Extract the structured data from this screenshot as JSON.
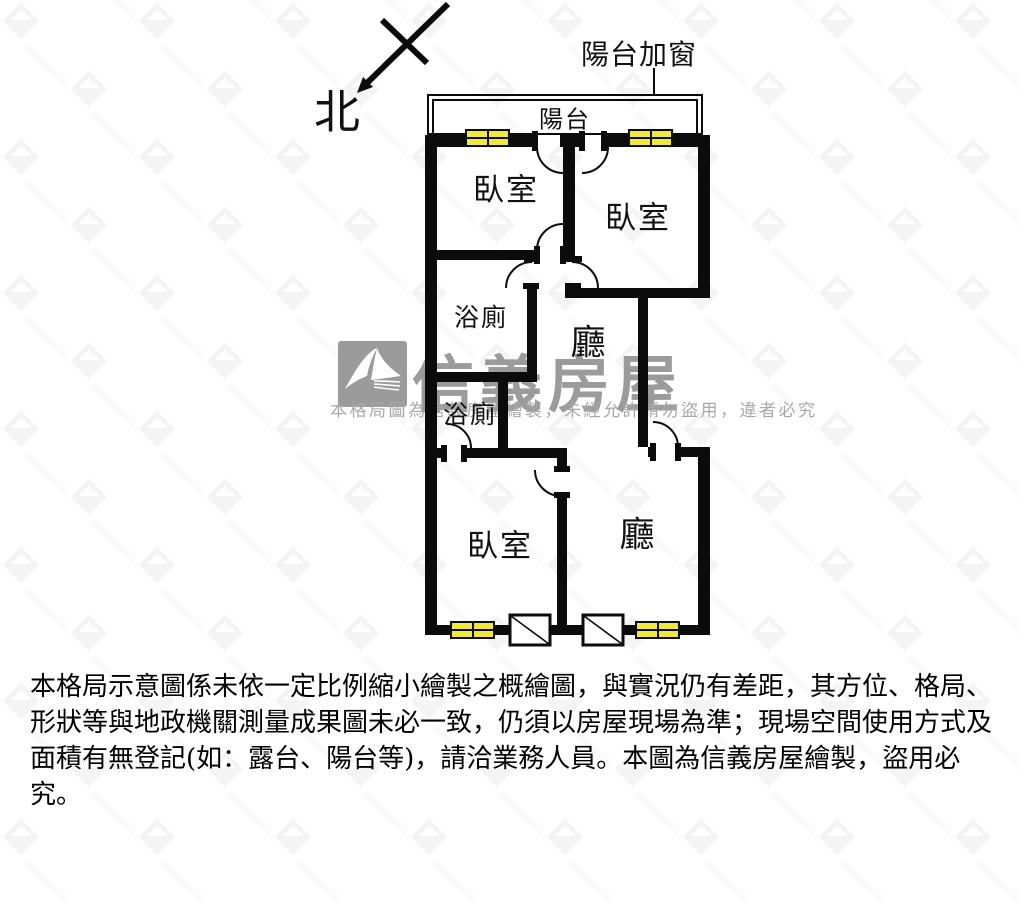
{
  "compass_label": "北",
  "balcony_window_note": "陽台加窗",
  "rooms": {
    "balcony": "陽台",
    "bedroom_top_left": "臥室",
    "bedroom_top_right": "臥室",
    "bathroom_upper": "浴廁",
    "bathroom_lower": "浴廁",
    "hall_upper": "廳",
    "hall_lower": "廳",
    "bedroom_bottom": "臥室"
  },
  "watermark": {
    "brand": "信義房屋",
    "notice": "本格局圖為信義房屋繪製，未經允許請勿盜用，違者必究"
  },
  "disclaimer_lines": [
    "本格局示意圖係未依一定比例縮小繪製之概繪圖，與實況仍有差距，其方位、格局、",
    "形狀等與地政機關測量成果圖未必一致，仍須以房屋現場為準；現場空間使用方式及",
    "面積有無登記(如：露台、陽台等)，請洽業務人員。本圖為信義房屋繪製，盜用必究。"
  ],
  "colors": {
    "wall": "#0b0b0b",
    "window_yellow": "#f0e93c",
    "watermark_gray": "#9b9b9b"
  }
}
